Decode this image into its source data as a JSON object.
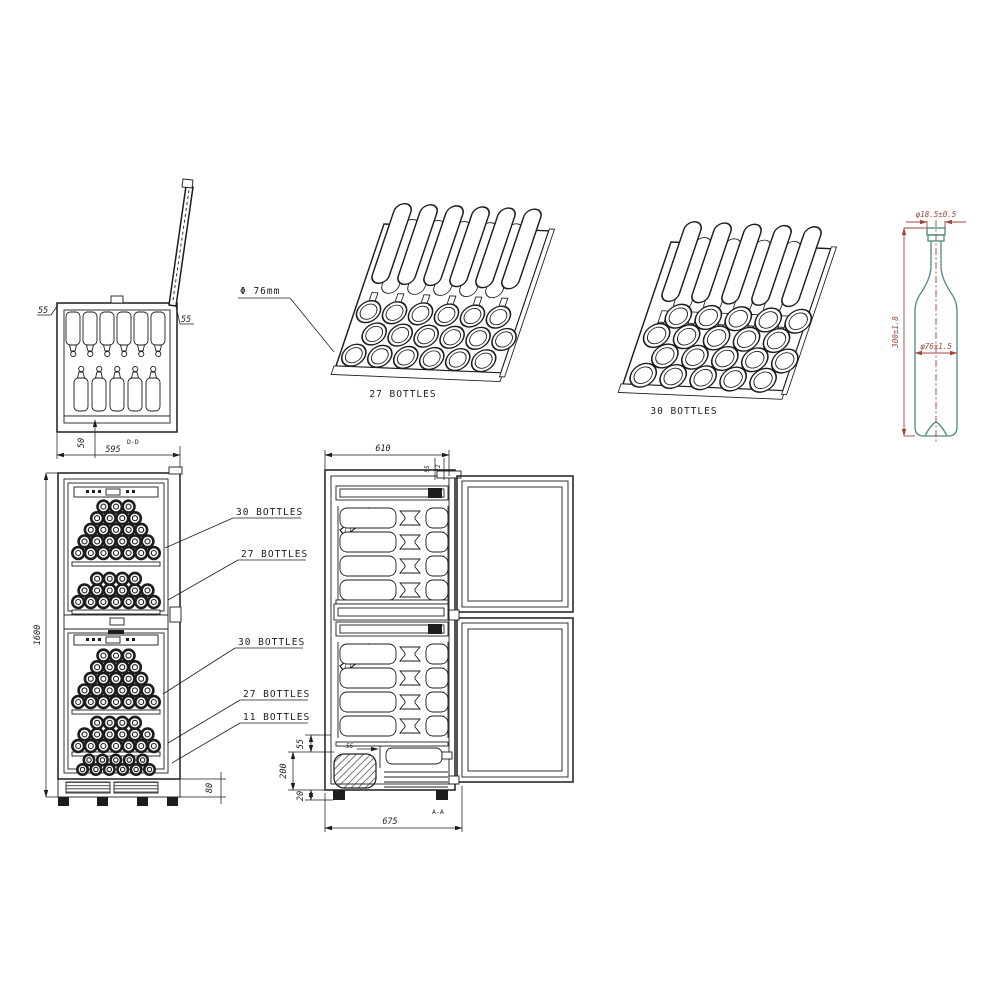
{
  "top_view": {
    "view_label": "D-D",
    "dim_width": "595",
    "dim_side_left": "55",
    "dim_side_right": "55",
    "dim_door": "50"
  },
  "rack_27": {
    "label": "27 BOTTLES",
    "note_diameter": "Φ 76mm"
  },
  "rack_30": {
    "label": "30 BOTTLES"
  },
  "bottle_view": {
    "dim_neck": "φ18.5±0.5",
    "dim_height": "300±1.8",
    "dim_body": "φ76±1.5",
    "outline_color": "#4d8a7e",
    "dim_color": "#a0453c"
  },
  "front_view": {
    "dim_height": "1600",
    "dim_base": "80",
    "callouts": [
      {
        "label": "30 BOTTLES"
      },
      {
        "label": "27 BOTTLES"
      },
      {
        "label": "30 BOTTLES"
      },
      {
        "label": "27 BOTTLES"
      },
      {
        "label": "11 BOTTLES"
      }
    ]
  },
  "side_view": {
    "view_label": "A-A",
    "dim_depth": "610",
    "dim_top_inner": "55",
    "dim_top_gap": "12",
    "dim_step": "55",
    "dim_upper": "55",
    "dim_compressor": "200",
    "dim_foot": "20",
    "dim_total": "675"
  }
}
